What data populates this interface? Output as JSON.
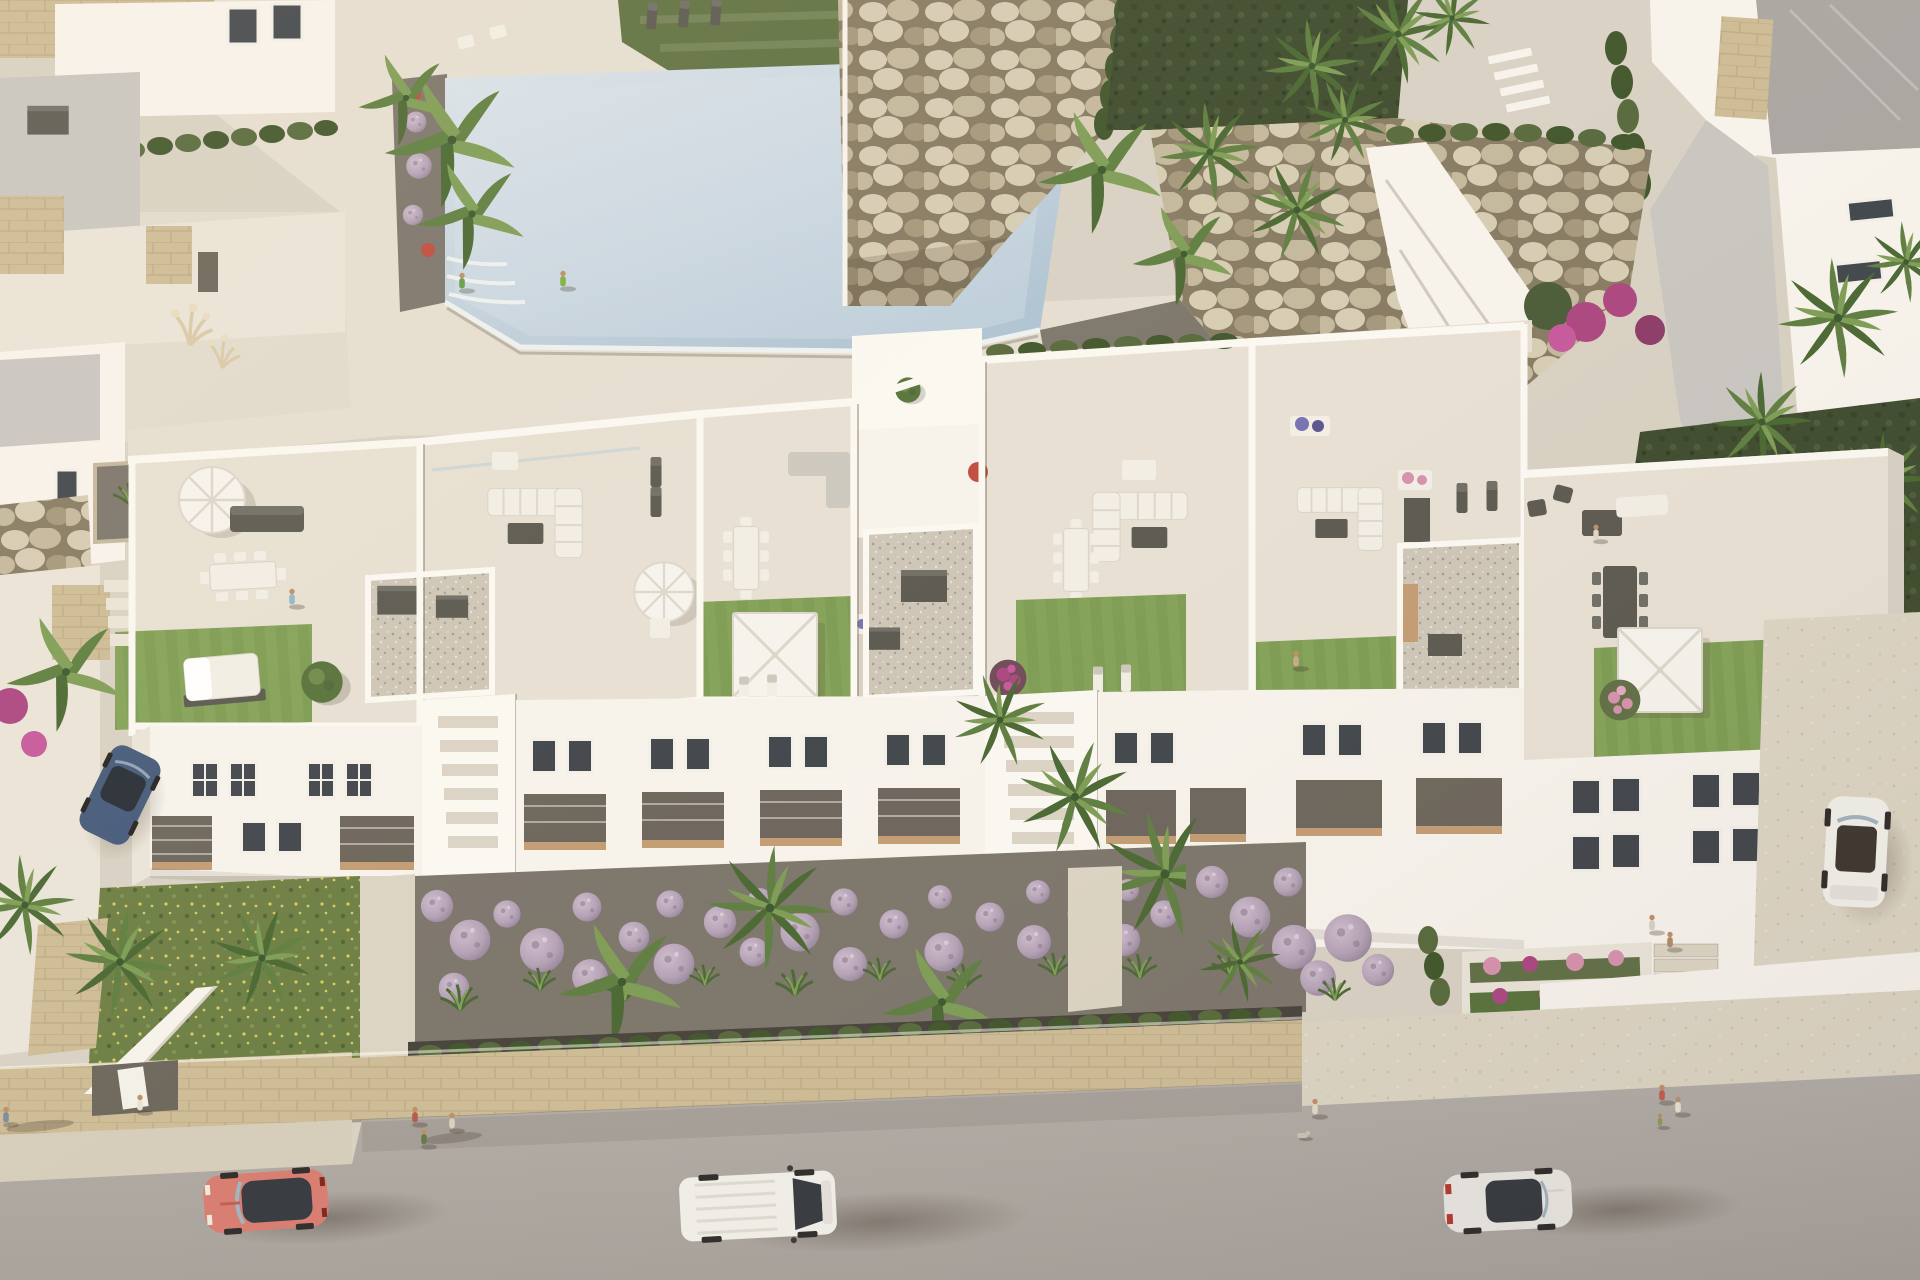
{
  "meta": {
    "description": "Aerial 3D architectural rendering of a modern white Mediterranean apartment complex at golden hour, viewed from above: rooftop terraces with lawns and parasols, a communal swimming pool with stepping stones, boulder rock gardens, lavender ball shrubs, palm trees, and a street with parked and passing vehicles and pedestrians.",
    "image_type": "photorealistic CGI render, no UI text"
  },
  "palette": {
    "sand": "#d8d1c3",
    "deckPool": "#e5ded1",
    "deckGray": "#c8c5c0",
    "lawnTop": "#5e7040",
    "lawnTopDark": "#4d5f35",
    "lawnRoof": "#7c9b51",
    "lawnRoofLight": "#8aa85e",
    "lawnWild": "#6b7d42",
    "lawnDeep": "#3d4a2c",
    "poolMain": "#c4d3df",
    "poolLight": "#dae3ea",
    "poolDeep": "#aec3d3",
    "poolRim": "#eef1f0",
    "rockBase": "#b4a88c",
    "rockLight": "#d6ccb3",
    "rockMid": "#c3b79c",
    "rockDark": "#a3967a",
    "rockShadow": "#857a61",
    "hedge": "#55683a",
    "hedgeDark": "#465a2e",
    "cypress": "#3f5429",
    "shrubGreen": "#55713a",
    "whiteLit": "#f7f3ec",
    "whiteTop": "#fbf8f2",
    "whiteMid": "#eae4d8",
    "whiteShade": "#d7d0c2",
    "whiteDeep": "#c0b8aa",
    "tile": "#e7e0d3",
    "tileShade": "#dbd3c5",
    "gravel": "#cdc5b6",
    "soil": "#454039",
    "bedGravel": "#7b746a",
    "glass": "#3f444a",
    "frame": "#f3f0e9",
    "recess": "#6b645a",
    "wood": "#c29b72",
    "furnDark": "#59574f",
    "furnDarkTop": "#6e6c64",
    "furnWhite": "#f2eee5",
    "cushion": "#ccc7bd",
    "umbWhite": "#f6f3ed",
    "umbRib": "#dcd6ca",
    "umbTan": "#c3a97c",
    "ballLight": "#c5b3c5",
    "ballDark": "#857287",
    "magenta": "#ab4480",
    "flowerRed": "#bf4a3c",
    "flowerBlue": "#7570b2",
    "flowerPink": "#d690ac",
    "palmLight": "#7d9c54",
    "palmMid": "#5d7d3e",
    "palmDark": "#486630",
    "trunk": "#9d8d6f",
    "stoneTan": "#cdbb95",
    "stoneTanDark": "#b2a07b",
    "sidewalk": "#d5ccba",
    "sidewalkR": "#dcd4c3",
    "road": "#b2aca6",
    "roadDark": "#a7a19b",
    "roofGray": "#a9a5a0",
    "glassCar": "#33383d",
    "carCoral": "#d87b6f",
    "carWhite": "#f2efe9",
    "carSilver": "#e9e6e1",
    "carBlue": "#43587a",
    "skin": "#bb8e67"
  },
  "scene": {
    "setting": "coastal residential development, late-afternoon sun from the left casting long shadows to the lower right",
    "building": {
      "blocks": 3,
      "visible_floors": 3,
      "roof_terraces": 6,
      "terrace_features": [
        "private lawns",
        "white square pergola parasols",
        "round parasols",
        "outdoor sofas",
        "dining sets",
        "gravel courts",
        "daybeds",
        "glass balustrades",
        "stair cores"
      ]
    },
    "amenities": [
      "communal swimming pool with stepping-stone crossing",
      "sun-lounger lawn",
      "boulder retaining rock walls",
      "landscaped walkways",
      "private street entrances"
    ],
    "vehicles": [
      {
        "name": "coral sports coupe",
        "color": "#d87b6f",
        "location": "road, bottom left"
      },
      {
        "name": "white panel van",
        "color": "#f2efe9",
        "location": "road, bottom center"
      },
      {
        "name": "silver sedan",
        "color": "#e9e6e1",
        "location": "road, bottom right"
      },
      {
        "name": "dark blue hatchback",
        "color": "#43587a",
        "location": "left side driveway"
      },
      {
        "name": "white car with open interior",
        "color": "#f2efe9",
        "location": "right side driveway"
      }
    ],
    "people": {
      "count": 17,
      "activities": [
        "standing at the pool edge",
        "walking on the pool deck",
        "sunbathing on loungers",
        "relaxing on roof terraces",
        "walking on the street",
        "walking a dog",
        "family strolling near the entrance"
      ]
    },
    "vegetation": [
      "fan palms",
      "banana plants",
      "lavender ball shrubs",
      "bougainvillea",
      "ornamental spiky grasses",
      "pampas grass",
      "cypress hedges",
      "boxwood hedge strips",
      "rooftop lawns",
      "wildflower lawn"
    ],
    "hardscape": [
      "boulder rock walls",
      "tan stone perimeter wall",
      "stone-paved sidewalks",
      "asphalt road",
      "white rendered walls",
      "gravel beds",
      "white outdoor stairs"
    ]
  }
}
